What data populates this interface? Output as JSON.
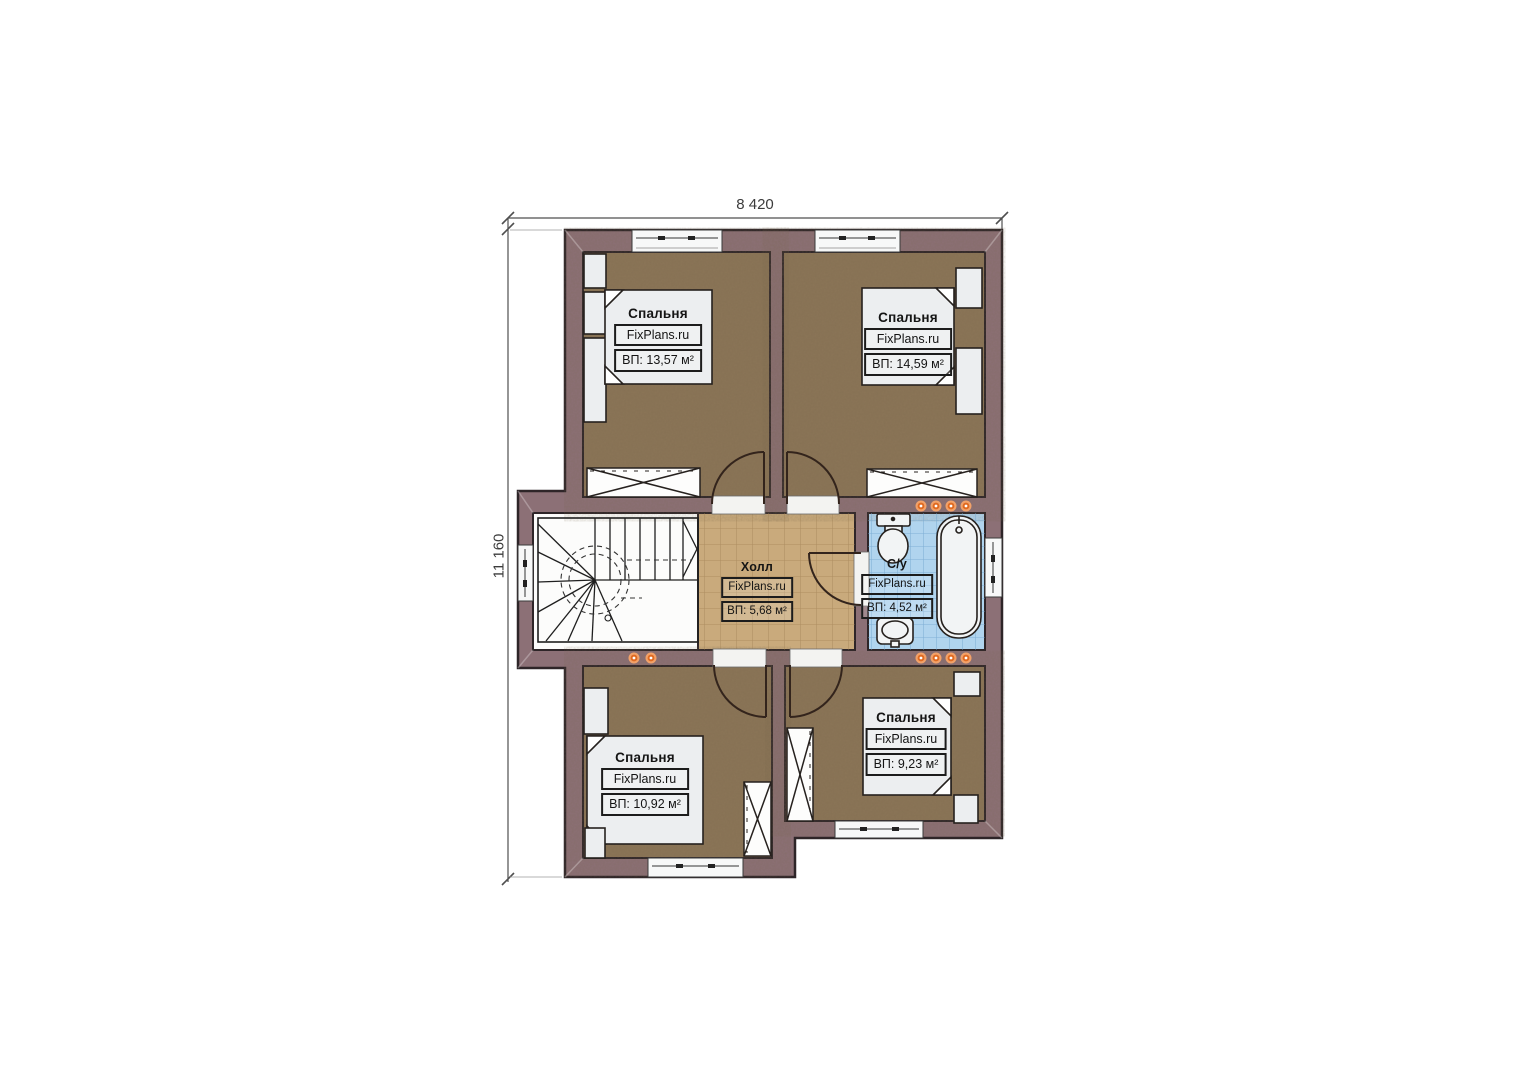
{
  "dimensions": {
    "top": "8 420",
    "left": "11 160"
  },
  "rooms": {
    "bedroom_top_left": {
      "name": "Спальня",
      "brand": "FixPlans.ru",
      "area": "ВП: 13,57 м²"
    },
    "bedroom_top_right": {
      "name": "Спальня",
      "brand": "FixPlans.ru",
      "area": "ВП: 14,59 м²"
    },
    "bedroom_bottom_left": {
      "name": "Спальня",
      "brand": "FixPlans.ru",
      "area": "ВП: 10,92 м²"
    },
    "bedroom_bottom_right": {
      "name": "Спальня",
      "brand": "FixPlans.ru",
      "area": "ВП: 9,23 м²"
    },
    "hall": {
      "name": "Холл",
      "brand": "FixPlans.ru",
      "area": "ВП: 5,68 м²"
    },
    "bathroom": {
      "name": "С/у",
      "brand": "FixPlans.ru",
      "area": "ВП: 4,52 м²"
    }
  },
  "colors": {
    "wall": "#8c7076",
    "wall_outline": "#2e2528",
    "bedroom_floor": "#8b7557",
    "hall_floor": "#c9aa7c",
    "bathroom_floor": "#b0d4ee",
    "stair_floor": "#fcfcfb",
    "furniture": "#eceef0",
    "wall_light": "#e06a20",
    "dimension_line": "#4f4f4f"
  }
}
